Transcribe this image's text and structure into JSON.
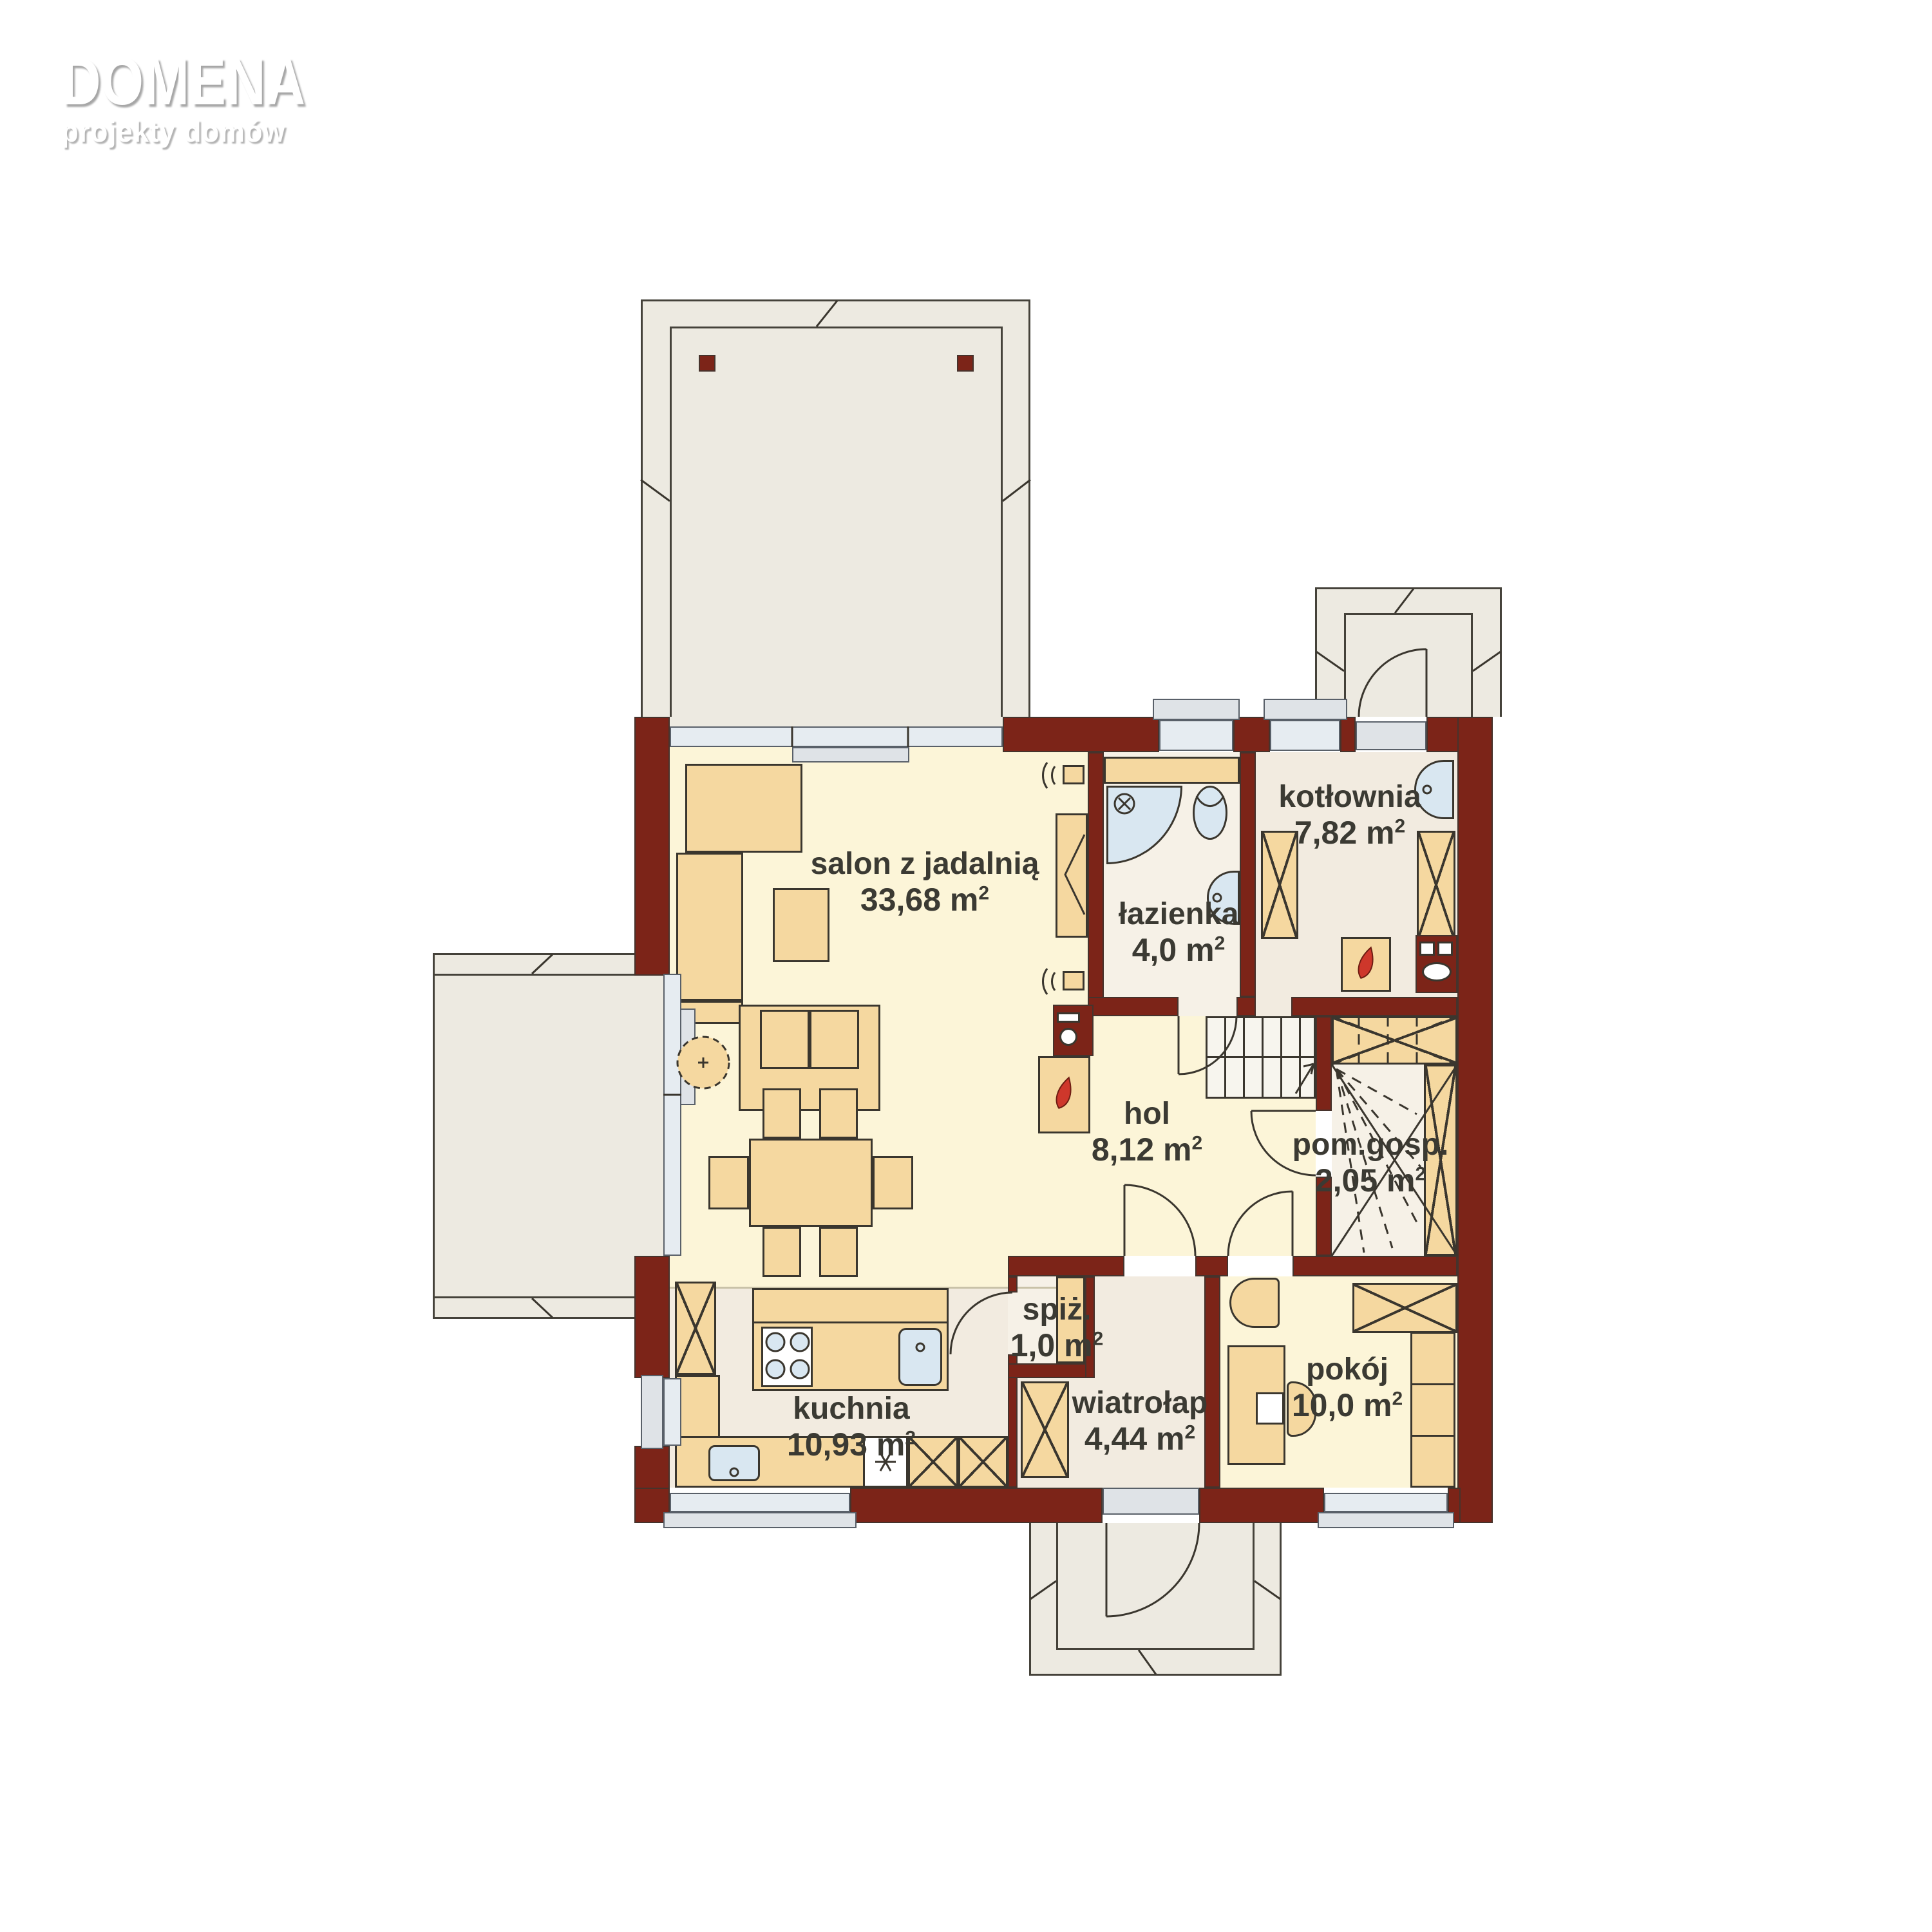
{
  "brand": {
    "name": "DOMENA",
    "tagline": "projekty domów"
  },
  "units": {
    "sup": "2"
  },
  "rooms": {
    "salon": {
      "name": "salon z jadalnią",
      "area": "33,68 m"
    },
    "lazienka": {
      "name": "łazienka",
      "area": "4,0 m"
    },
    "kotlownia": {
      "name": "kotłownia",
      "area": "7,82 m"
    },
    "hol": {
      "name": "hol",
      "area": "8,12 m"
    },
    "pomgosp": {
      "name": "pom.gosp.",
      "area": "2,05 m"
    },
    "pokoj": {
      "name": "pokój",
      "area": "10,0 m"
    },
    "spiz": {
      "name": "spiż.",
      "area": "1,0 m"
    },
    "kuchnia": {
      "name": "kuchnia",
      "area": "10,93 m"
    },
    "wiatrolap": {
      "name": "wiatrołap",
      "area": "4,44 m"
    }
  },
  "colors": {
    "wall": "#7c2418",
    "floor": "#fcf5d8",
    "service": "#f2ebe0",
    "pink": "#f6f1e7",
    "furn": "#f5d8a0",
    "terrace": "#edeae1",
    "glass": "#e6ecf1",
    "fix": "#d9e7f1",
    "stair": "#f7f5ee",
    "flame": "#ce372b",
    "line": "#3a362e",
    "text": "#3b3a33"
  }
}
